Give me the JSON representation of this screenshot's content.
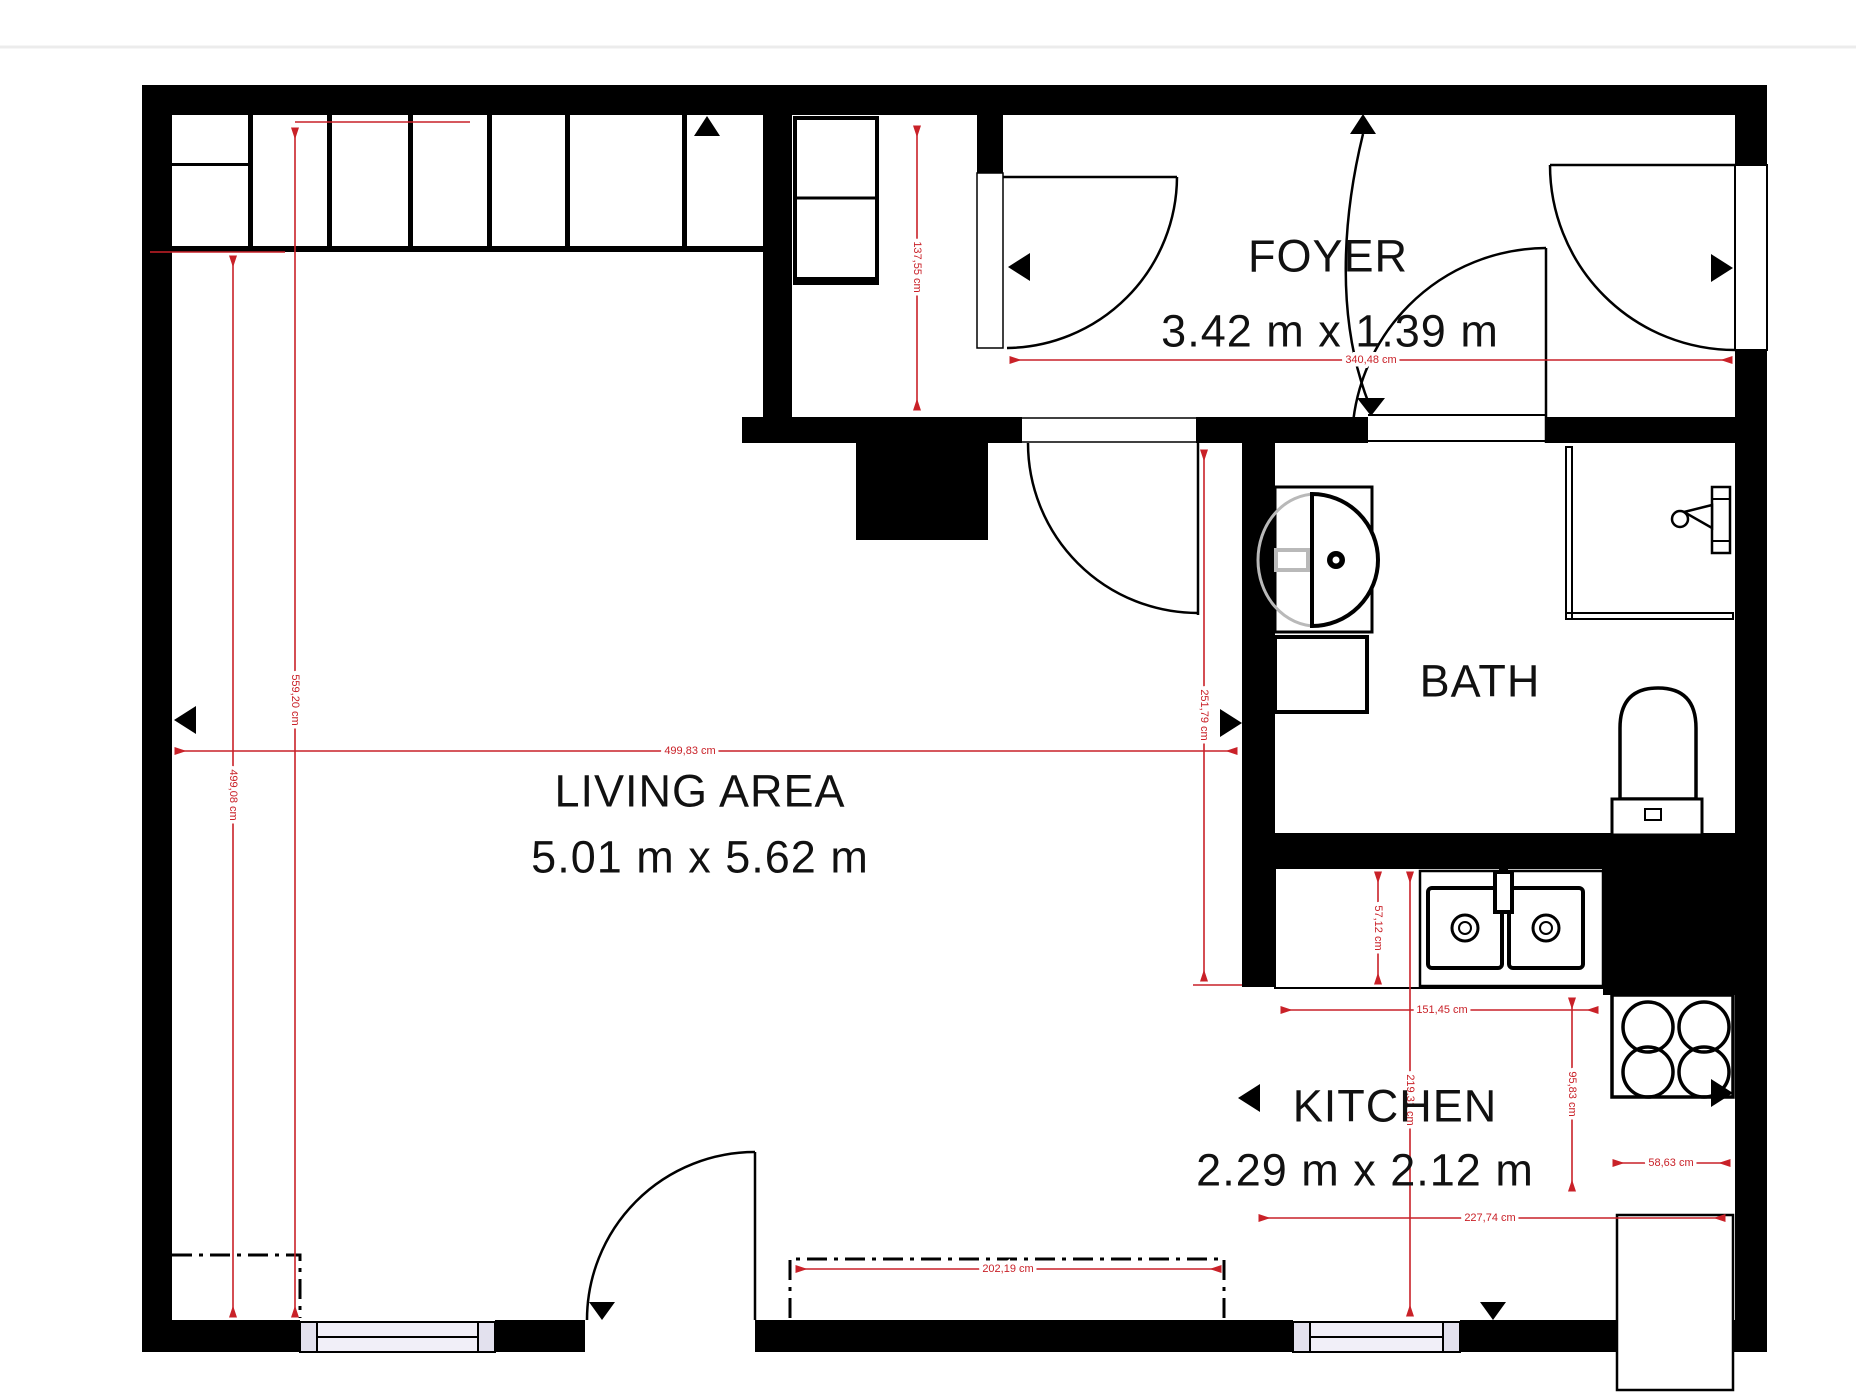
{
  "rooms": {
    "foyer": {
      "name": "FOYER",
      "dims": "3.42 m x 1.39 m"
    },
    "living": {
      "name": "LIVING AREA",
      "dims": "5.01 m x 5.62 m"
    },
    "bath": {
      "name": "BATH"
    },
    "kitchen": {
      "name": "KITCHEN",
      "dims": "2.29 m x 2.12 m"
    }
  },
  "measurements": {
    "closet_wall_height": {
      "label": "559,20 cm"
    },
    "living_wall_height": {
      "label": "499,08 cm"
    },
    "living_width": {
      "label": "499,83 cm"
    },
    "foyer_width": {
      "label": "340,48 cm"
    },
    "foyer_depth": {
      "label": "137,55 cm"
    },
    "corridor_height": {
      "label": "251,79 cm"
    },
    "counter_depth": {
      "label": "57,12 cm"
    },
    "counter_width": {
      "label": "151,45 cm"
    },
    "stove_side_height": {
      "label": "95,83 cm"
    },
    "stove_side_width": {
      "label": "58,63 cm"
    },
    "kitchen_width": {
      "label": "227,74 cm"
    },
    "kitchen_depth": {
      "label": "219,31 cm"
    },
    "sofa_width": {
      "label": "202,19 cm"
    }
  },
  "colors": {
    "wall": "#000000",
    "dimension_red": "#c92128",
    "window_fill": "#f1eff8",
    "window_cap": "#e3e1ee",
    "fixture_gray": "#b9b9b9",
    "page_divider": "#ececec"
  }
}
